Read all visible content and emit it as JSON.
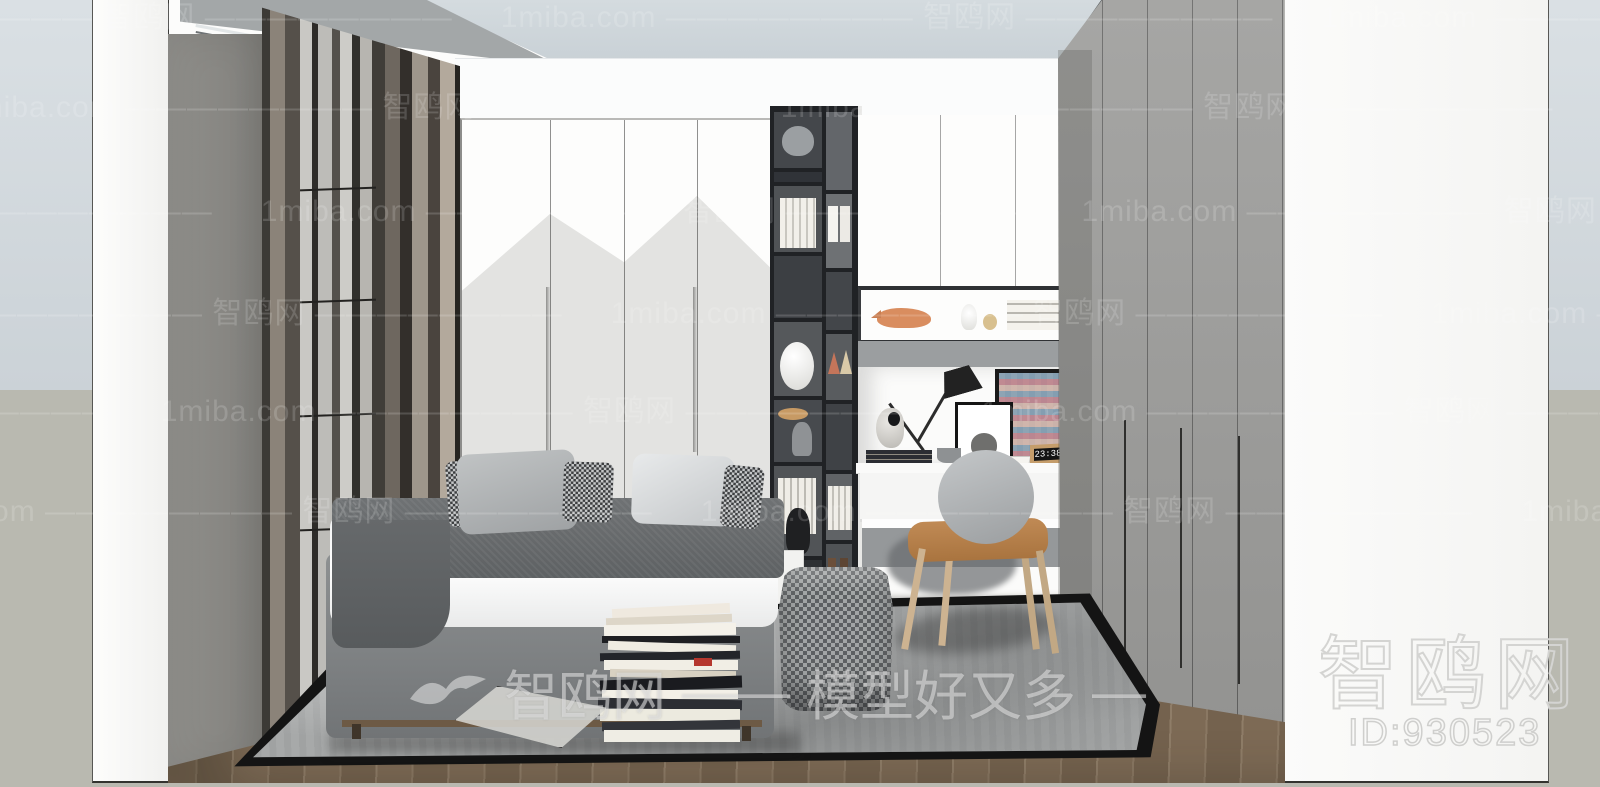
{
  "watermarks": {
    "site_en": "1miba.com",
    "site_cn": "智鸥网",
    "tile_text": "1miba.com ———————— 智鸥网 ————————",
    "center": {
      "brand": "智鸥网",
      "dash_mid": "——",
      "tagline": "模型好又多",
      "dash_right": "—"
    },
    "corner": {
      "brand": "智鸥网",
      "model_id": "ID:930523"
    }
  },
  "scene": {
    "clock_time": "23:38"
  },
  "palette": {
    "background_top": "#d3dade",
    "background_bottom": "#b9b9b0",
    "wall_white": "#fcfcfb",
    "wardrobe_gray": "#9c9c9a",
    "door_accent_gray": "#e3e3e1",
    "floor_wood": "#83705c",
    "rug_gray": "#a7a9a9",
    "chair_seat_tan": "#b97f4f",
    "rhino_orange": "#d98d5f",
    "clock_wood": "#c59d6b"
  }
}
